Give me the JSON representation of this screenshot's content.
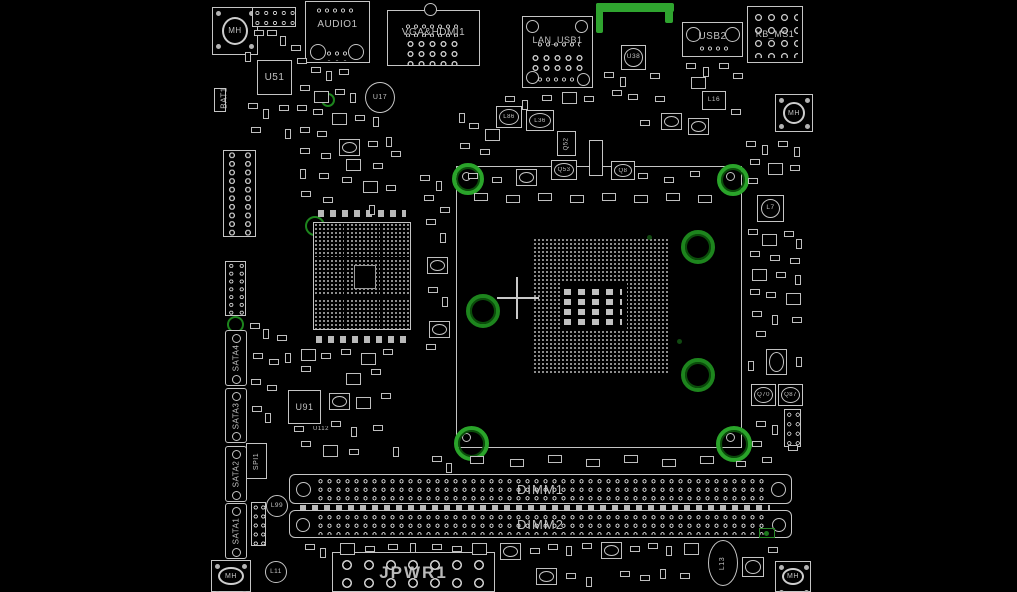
{
  "colors": {
    "background": "#000000",
    "board_outline": "#c5c5c5",
    "highlight_green": "#2fa42f"
  },
  "connectors": {
    "audio": "AUDIO1",
    "vga_hdmi": "VGA&HDMI1",
    "lan_usb": "LAN_USB1",
    "usb2": "USB2",
    "kb_ms": "KB_MS1",
    "sata1": "SATA1",
    "sata2": "SATA2",
    "sata3": "SATA3",
    "sata4": "SATA4",
    "spi": "SPI1",
    "dimm1": "DIMM1",
    "dimm2": "DIMM2",
    "jpwr": "JPWR1",
    "battery": "BAT1"
  },
  "ics": {
    "u51": "U51",
    "u17": "U17",
    "u38": "U38",
    "u91": "U91",
    "u112": "U112"
  },
  "passives": {
    "l7": "L7",
    "l11": "L11",
    "l13": "L13",
    "l16": "L16",
    "l36": "L36",
    "l86": "L86",
    "l99": "L99",
    "q8": "Q8",
    "q52": "Q52",
    "q53": "Q53",
    "q70": "Q70",
    "q87": "Q87"
  },
  "markers": {
    "mounting_hole": "MH"
  }
}
